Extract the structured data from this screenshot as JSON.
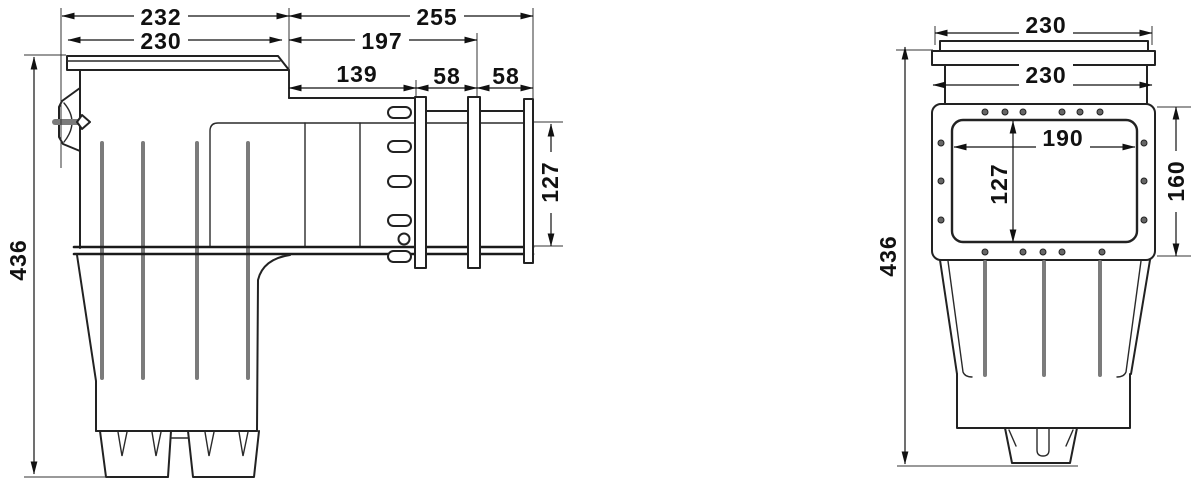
{
  "meta": {
    "type": "technical-dimension-drawing",
    "subject": "Skimmer two-view dimensional drawing (units mm)"
  },
  "colors": {
    "line": "#222222",
    "rib": "#7b7b7b",
    "background": "#ffffff"
  },
  "side_view": {
    "name": "side-view",
    "dimensions": {
      "overall_width": "232",
      "lid_width": "230",
      "throat_length": "255",
      "flange2_offset": "197",
      "flange1_offset": "139",
      "flange_gap_1": "58",
      "flange_gap_2": "58",
      "throat_height": "127",
      "overall_height": "436"
    }
  },
  "front_view": {
    "name": "front-view",
    "dimensions": {
      "lid_width": "230",
      "body_width": "230",
      "opening_width": "190",
      "opening_height": "127",
      "faceplate_height": "160",
      "overall_height": "436"
    }
  }
}
